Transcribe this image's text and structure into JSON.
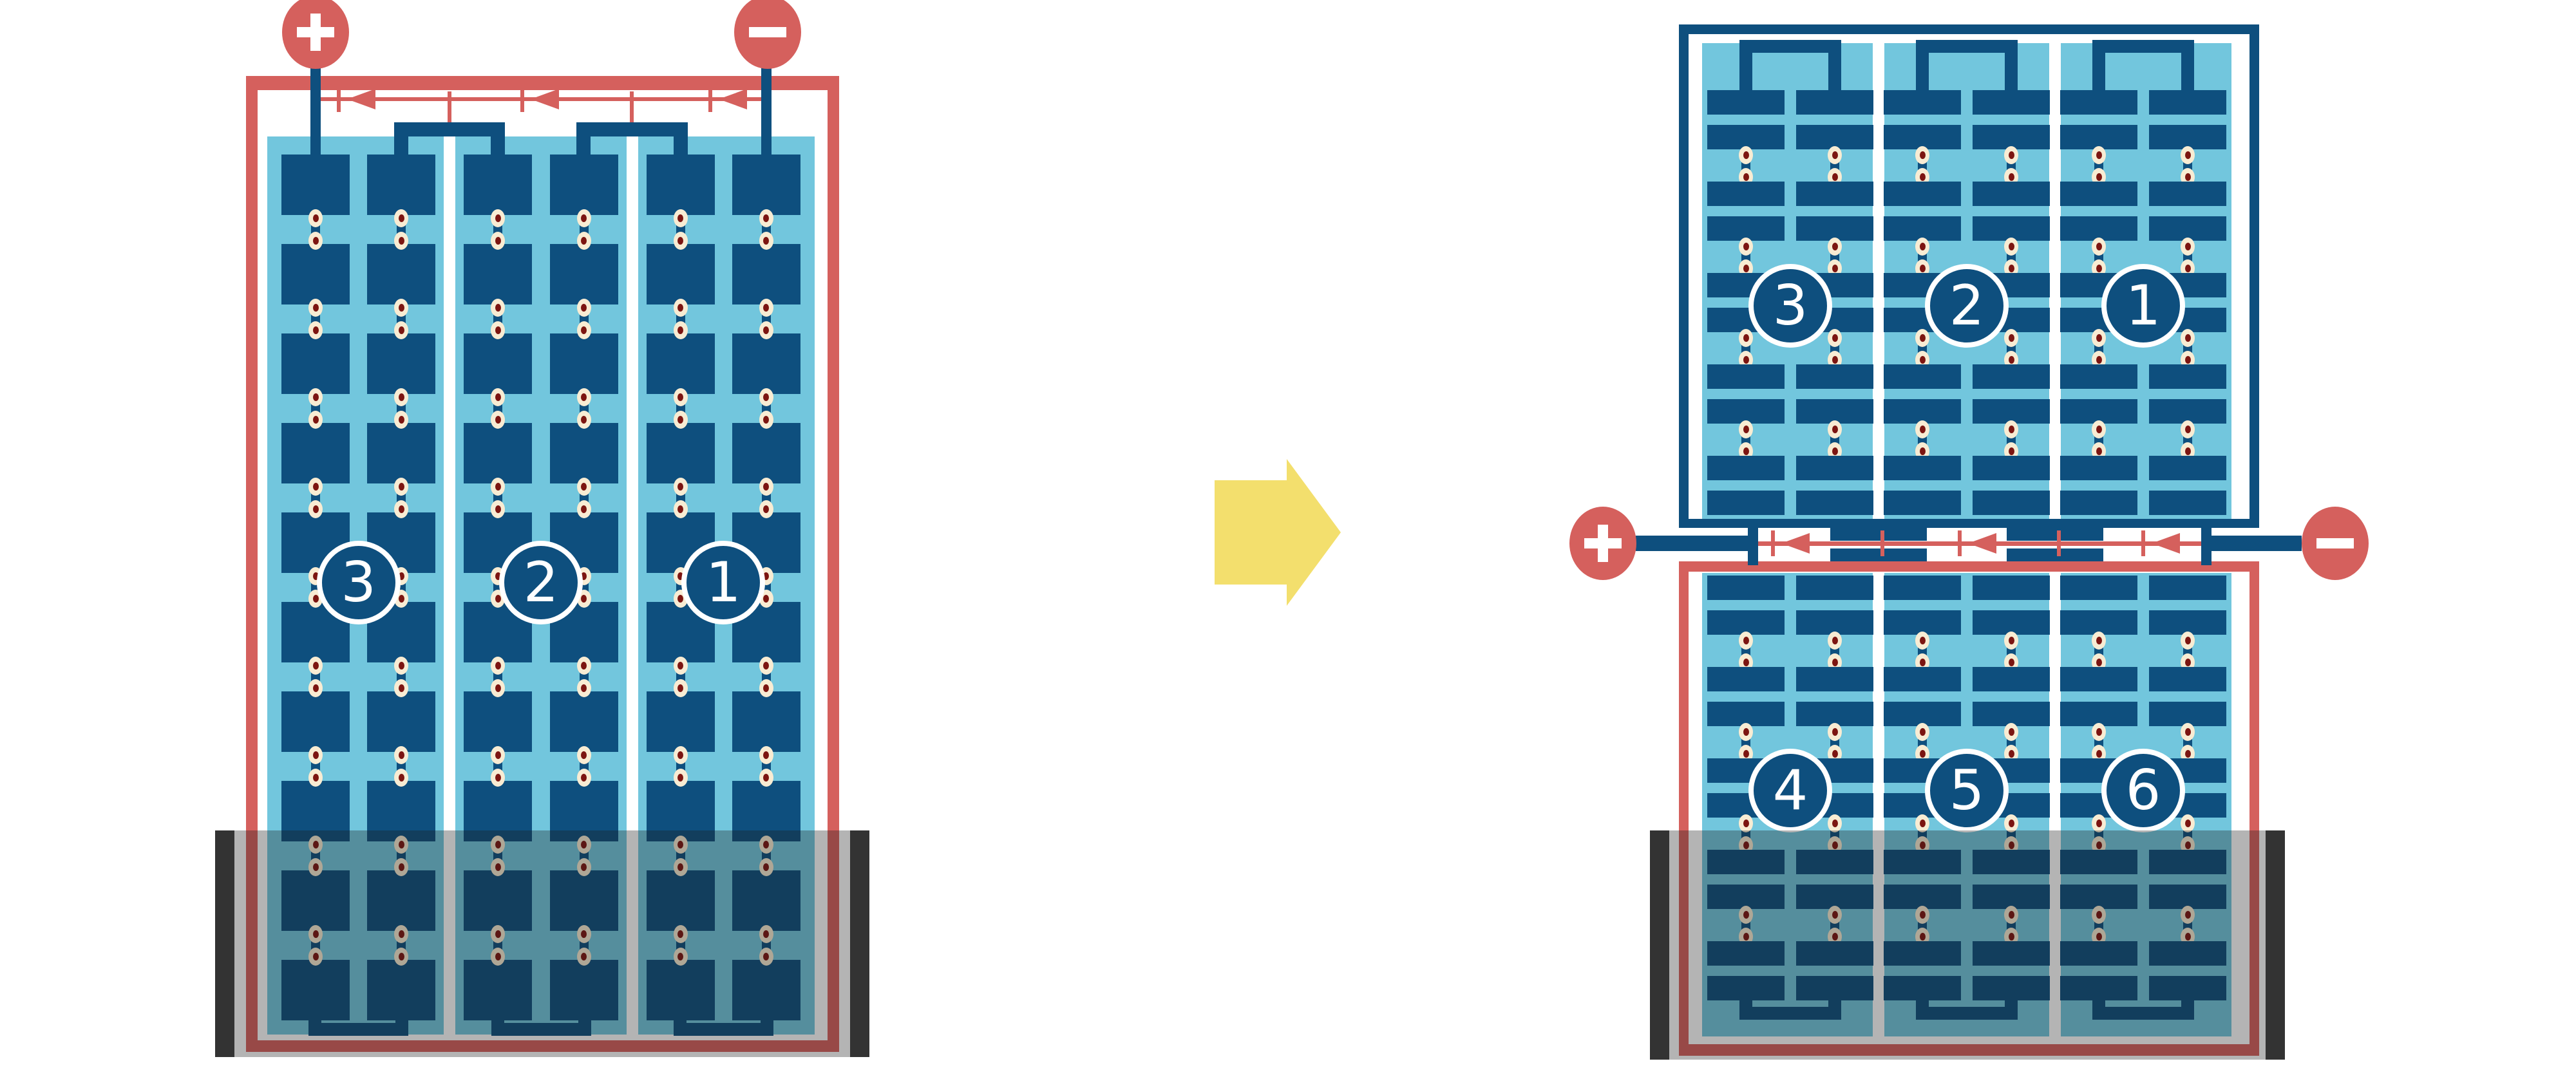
{
  "colors": {
    "red": "#d5605d",
    "navy": "#0e4f7e",
    "panel_blue": "#72c6dd",
    "cream": "#f8ecd3",
    "maroon": "#7c1511",
    "arrow_yellow": "#f3df6d",
    "shade": "rgba(28,28,28,0.33)",
    "shade_cap": "#333333",
    "separator_white": "#ffffff"
  },
  "left_module": {
    "kind": "full-cell module",
    "terminal_positive_label": "+",
    "terminal_negative_label": "−",
    "bypass_diode_count": 3,
    "cell_rows": 10,
    "cell_columns": 6,
    "strings": [
      {
        "number": "3"
      },
      {
        "number": "2"
      },
      {
        "number": "1"
      }
    ]
  },
  "right_module": {
    "kind": "half-cut-cell module",
    "terminal_positive_label": "+",
    "terminal_negative_label": "−",
    "bypass_diode_count": 3,
    "upper_half": {
      "half_cell_row_pairs": 5,
      "strings": [
        {
          "number": "3"
        },
        {
          "number": "2"
        },
        {
          "number": "1"
        }
      ]
    },
    "lower_half": {
      "half_cell_row_pairs": 5,
      "strings": [
        {
          "number": "4"
        },
        {
          "number": "5"
        },
        {
          "number": "6"
        }
      ]
    }
  },
  "transform_arrow": {
    "direction": "right"
  },
  "shade_bands": {
    "left": true,
    "right": true
  }
}
